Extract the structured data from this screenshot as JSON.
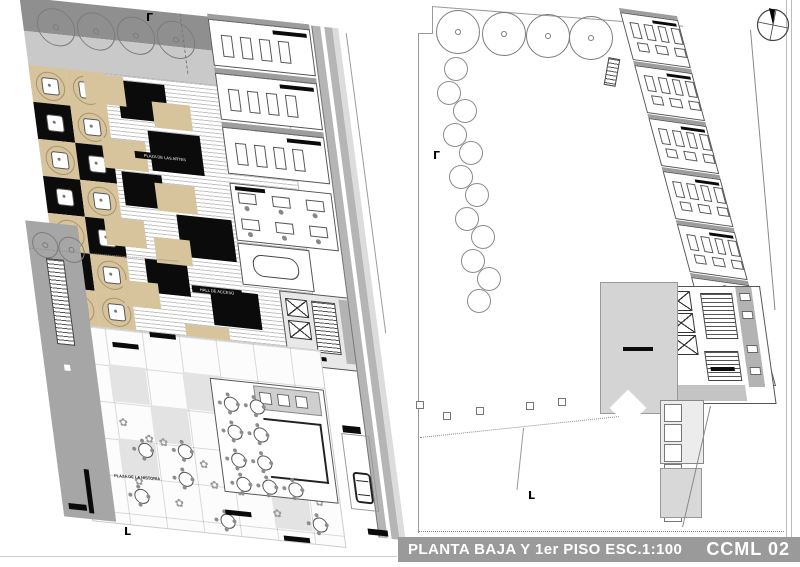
{
  "titlebar": {
    "title": "PLANTA BAJA Y 1er PISO  ESC.1:100",
    "code": "CCML 02",
    "bg": "#9a9a9a",
    "text_color": "#ffffff"
  },
  "colors": {
    "plaza_tan": "#d7c49c",
    "plaza_black": "#0b0b0b",
    "wall_gray": "#9d9d9d",
    "band_gray": "#b5b5b5",
    "terrace_gray": "#d4d4d4",
    "paper": "#ffffff"
  },
  "left_plan": {
    "labels": {
      "plaza_artes": "PLAZA DE LAS ARTES",
      "hall_acceso": "HALL DE ACCESO",
      "plaza_historia": "PLAZA DE LA HISTORIA"
    },
    "trees": [
      [
        22,
        4
      ],
      [
        62,
        4
      ],
      [
        102,
        4
      ],
      [
        142,
        4
      ]
    ],
    "strip_trees": [
      [
        -12,
        232
      ],
      [
        14,
        234
      ]
    ],
    "checker_cells": [
      {
        "x": 8,
        "y": 64,
        "c": "tan"
      },
      {
        "x": 45,
        "y": 64,
        "c": "tan"
      },
      {
        "x": 8,
        "y": 101,
        "c": "black"
      },
      {
        "x": 45,
        "y": 101,
        "c": "tan"
      },
      {
        "x": 8,
        "y": 138,
        "c": "tan"
      },
      {
        "x": 45,
        "y": 138,
        "c": "black"
      },
      {
        "x": 8,
        "y": 175,
        "c": "black"
      },
      {
        "x": 45,
        "y": 175,
        "c": "tan"
      },
      {
        "x": 8,
        "y": 212,
        "c": "tan"
      },
      {
        "x": 45,
        "y": 212,
        "c": "black"
      },
      {
        "x": 8,
        "y": 249,
        "c": "black"
      },
      {
        "x": 45,
        "y": 249,
        "c": "tan"
      },
      {
        "x": 8,
        "y": 286,
        "c": "tan"
      },
      {
        "x": 45,
        "y": 286,
        "c": "tan"
      }
    ],
    "big_blocks": [
      {
        "x": 95,
        "y": 70,
        "w": 48,
        "h": 38,
        "c": "black"
      },
      {
        "x": 120,
        "y": 118,
        "w": 52,
        "h": 40,
        "c": "black"
      },
      {
        "x": 88,
        "y": 162,
        "w": 40,
        "h": 34,
        "c": "black"
      },
      {
        "x": 138,
        "y": 200,
        "w": 55,
        "h": 42,
        "c": "black"
      },
      {
        "x": 100,
        "y": 248,
        "w": 42,
        "h": 34,
        "c": "black"
      },
      {
        "x": 162,
        "y": 272,
        "w": 48,
        "h": 36,
        "c": "black"
      },
      {
        "x": 62,
        "y": 66,
        "w": 40,
        "h": 30,
        "c": "tan"
      },
      {
        "x": 128,
        "y": 88,
        "w": 38,
        "h": 26,
        "c": "tan"
      },
      {
        "x": 72,
        "y": 130,
        "w": 44,
        "h": 30,
        "c": "tan"
      },
      {
        "x": 120,
        "y": 170,
        "w": 40,
        "h": 28,
        "c": "tan"
      },
      {
        "x": 64,
        "y": 210,
        "w": 40,
        "h": 28,
        "c": "tan"
      },
      {
        "x": 112,
        "y": 225,
        "w": 36,
        "h": 26,
        "c": "tan"
      },
      {
        "x": 74,
        "y": 272,
        "w": 36,
        "h": 26,
        "c": "tan"
      },
      {
        "x": 132,
        "y": 310,
        "w": 44,
        "h": 30,
        "c": "tan"
      }
    ],
    "classroom_count": 3,
    "office_desks": [
      [
        6,
        8
      ],
      [
        40,
        8
      ],
      [
        74,
        8
      ],
      [
        6,
        34
      ],
      [
        40,
        34
      ],
      [
        74,
        34
      ]
    ],
    "cafe_tables": [
      [
        10,
        16
      ],
      [
        36,
        16
      ],
      [
        10,
        44
      ],
      [
        36,
        44
      ],
      [
        10,
        72
      ],
      [
        36,
        72
      ],
      [
        12,
        96
      ],
      [
        38,
        96
      ],
      [
        64,
        96
      ]
    ],
    "terrace_tables": [
      [
        68,
        435
      ],
      [
        105,
        460
      ],
      [
        58,
        482
      ],
      [
        142,
        498
      ],
      [
        108,
        432
      ],
      [
        235,
        492
      ]
    ],
    "flowers": [
      [
        52,
        412
      ],
      [
        90,
        428
      ],
      [
        128,
        446
      ],
      [
        60,
        470
      ],
      [
        98,
        488
      ],
      [
        136,
        466
      ],
      [
        76,
        426
      ],
      [
        162,
        470
      ],
      [
        196,
        488
      ],
      [
        240,
        472
      ]
    ],
    "bench_bars": [
      [
        95,
        322
      ],
      [
        56,
        336
      ],
      [
        148,
        494
      ],
      [
        204,
        514
      ]
    ],
    "gray_cells": [
      [
        49,
        359
      ],
      [
        123,
        359
      ],
      [
        86,
        396
      ],
      [
        160,
        433
      ],
      [
        49,
        433
      ],
      [
        197,
        470
      ]
    ],
    "flower_glyph": "✿"
  },
  "right_plan": {
    "trees": [
      [
        28,
        10
      ],
      [
        74,
        12
      ],
      [
        118,
        14
      ],
      [
        161,
        16
      ]
    ],
    "circle_chain": [
      [
        36,
        57
      ],
      [
        29,
        81
      ],
      [
        45,
        99
      ],
      [
        35,
        123
      ],
      [
        51,
        141
      ],
      [
        41,
        165
      ],
      [
        57,
        183
      ],
      [
        47,
        207
      ],
      [
        63,
        225
      ],
      [
        53,
        249
      ],
      [
        69,
        267
      ],
      [
        59,
        289
      ]
    ],
    "classroom_count": 7,
    "column_squares": [
      [
        8,
        401
      ],
      [
        35,
        412
      ],
      [
        68,
        407
      ],
      [
        118,
        402
      ],
      [
        150,
        398
      ]
    ],
    "storage_cells": 6
  }
}
